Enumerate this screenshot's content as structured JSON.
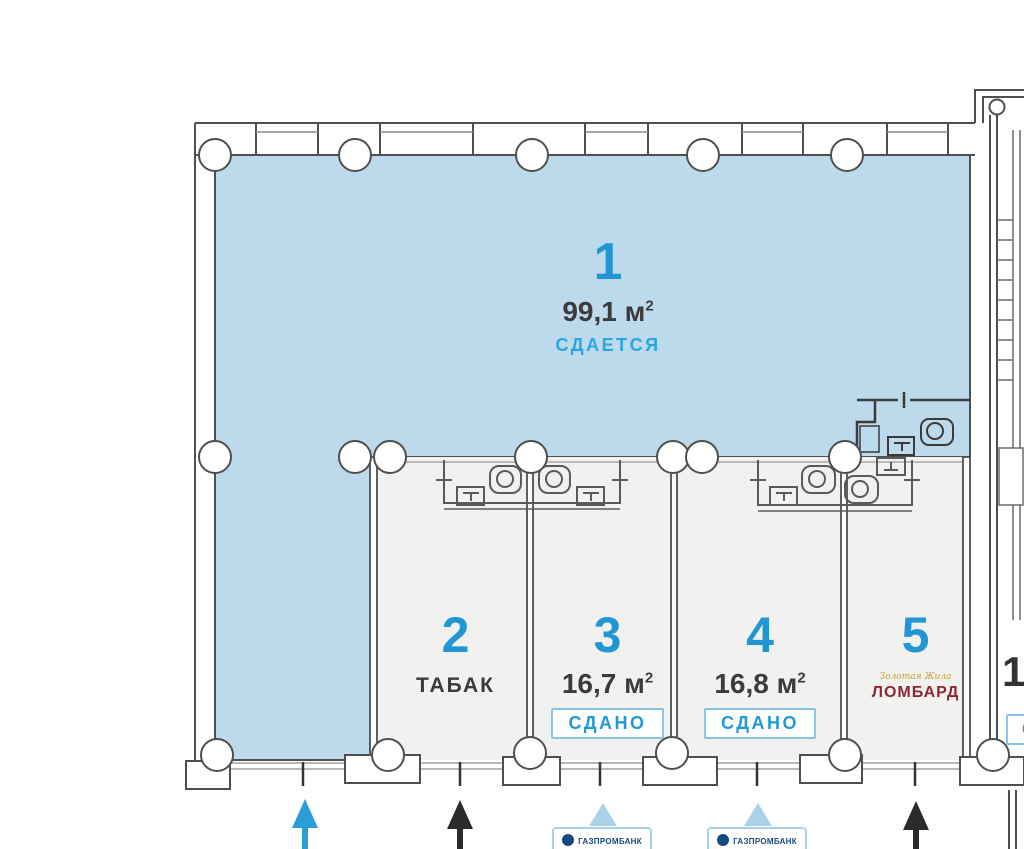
{
  "units": [
    {
      "number": "1",
      "area_value": "99,1 м",
      "area_sup": "2",
      "status": "СДАЕТСЯ"
    },
    {
      "number": "2",
      "tenant": "ТАБАК"
    },
    {
      "number": "3",
      "area_value": "16,7 м",
      "area_sup": "2",
      "status": "СДАНО"
    },
    {
      "number": "4",
      "area_value": "16,8 м",
      "area_sup": "2",
      "status": "СДАНО"
    },
    {
      "number": "5",
      "tenant_script": "Золотая Жила",
      "tenant": "ЛОМБАРД"
    },
    {
      "number": "1",
      "status": "С"
    }
  ],
  "atm_boxes": [
    {
      "label": "ГАЗПРОМБАНК"
    },
    {
      "label": "ГАЗПРОМБАНК"
    }
  ],
  "colors": {
    "floor_available": "#bcdaeb",
    "floor_rented": "#f1f1ef",
    "unit_number": "#2196d3",
    "status_available": "#2aa7e1",
    "badge_text": "#1e9ad6",
    "badge_border": "#86c5e5",
    "lombard_red": "#8e2633",
    "brand_gold": "#c8a22a",
    "bank_navy": "#16497f",
    "arrow_blue": "#2b9ed9",
    "arrow_black": "#2b2b2b",
    "wall_gray": "#4f4f4f"
  }
}
